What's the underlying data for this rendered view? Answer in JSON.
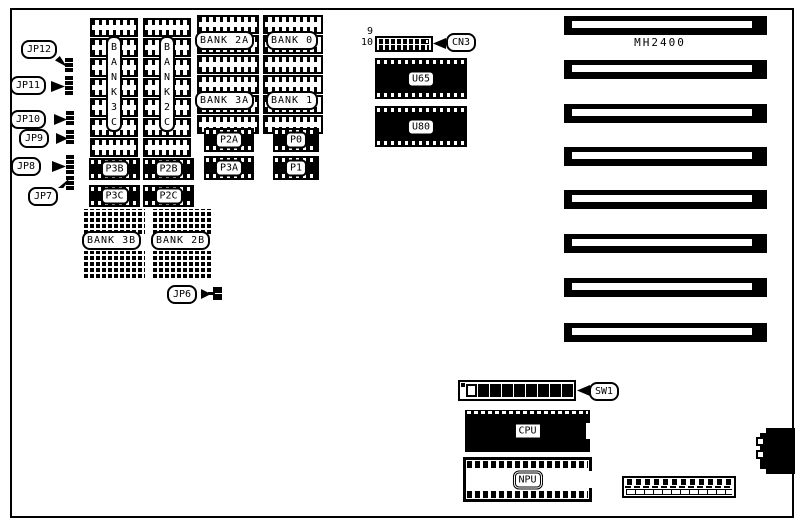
{
  "diagram": {
    "model": "MH2400",
    "background_color": "#ffffff",
    "ink_color": "#000000"
  },
  "jumpers": {
    "jp6": "JP6",
    "jp7": "JP7",
    "jp8": "JP8",
    "jp9": "JP9",
    "jp10": "JP10",
    "jp11": "JP11",
    "jp12": "JP12"
  },
  "connectors": {
    "cn3": {
      "label": "CN3",
      "pin_top_label": "9",
      "pin_bottom_label": "10"
    },
    "sw1": {
      "label": "SW1",
      "positions": 9
    },
    "expansion_slots": {
      "count": 8
    }
  },
  "chips": {
    "u65": "U65",
    "u80": "U80",
    "cpu": "CPU",
    "npu": "NPU"
  },
  "memory": {
    "bank3c": "BANK3C",
    "bank2c": "BANK2C",
    "bank2a": "BANK 2A",
    "bank0": "BANK 0",
    "bank3a": "BANK 3A",
    "bank1": "BANK 1",
    "bank3b": "BANK 3B",
    "bank2b": "BANK 2B",
    "p3b": "P3B",
    "p2b": "P2B",
    "p3c": "P3C",
    "p2c": "P2C",
    "p2a": "P2A",
    "p0": "P0",
    "p3a": "P3A",
    "p1": "P1"
  }
}
